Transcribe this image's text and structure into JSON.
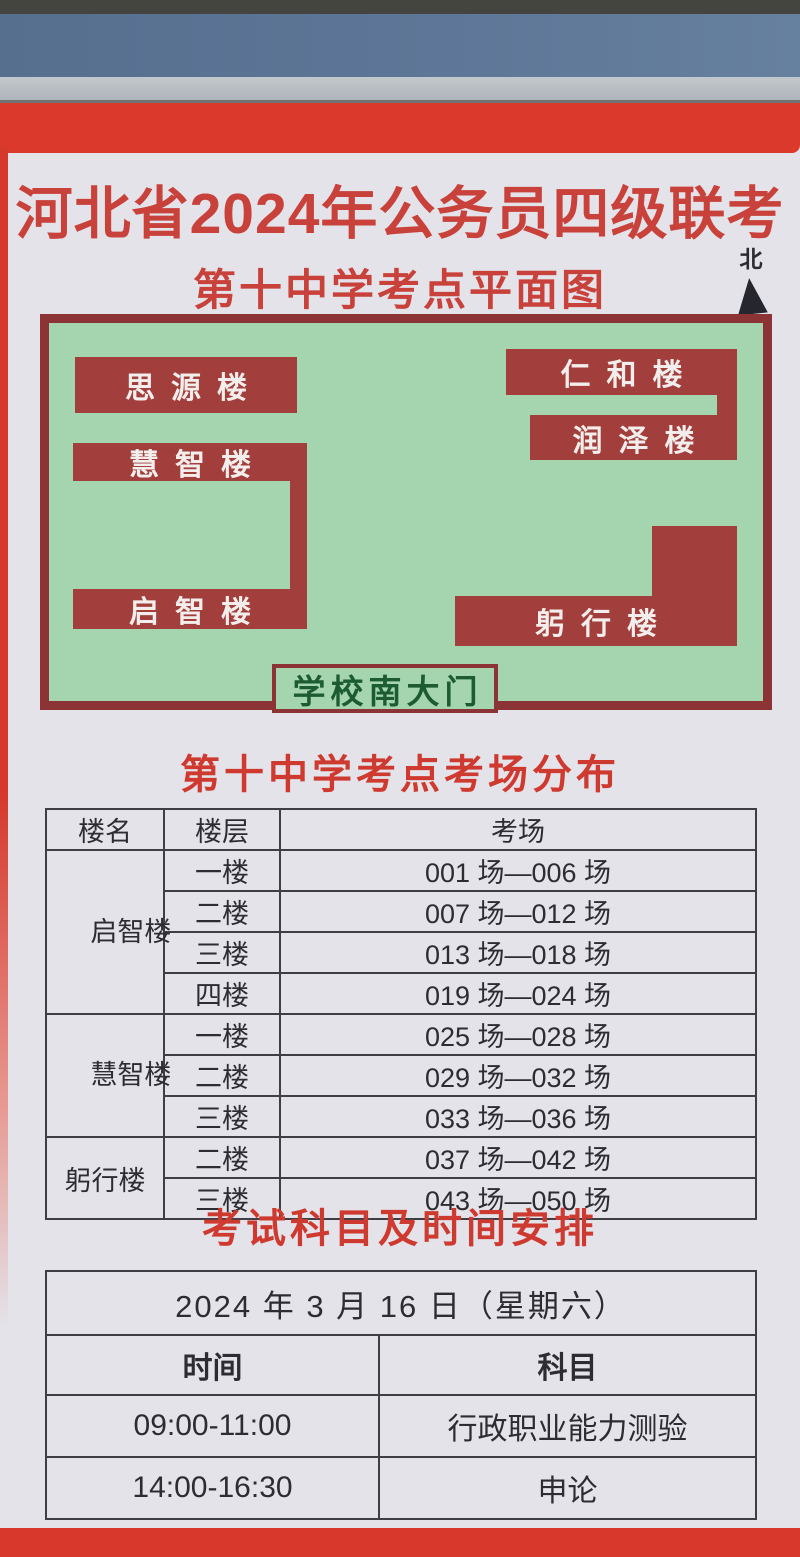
{
  "poster": {
    "title": "河北省2024年公务员四级联考",
    "subtitle": "第十中学考点平面图",
    "north_label": "北",
    "map": {
      "buildings": [
        {
          "id": "siyuan",
          "label": "思源楼"
        },
        {
          "id": "renhe",
          "label": "仁和楼"
        },
        {
          "id": "runze",
          "label": "润泽楼"
        },
        {
          "id": "huizhi",
          "label": "慧智楼"
        },
        {
          "id": "qizhi",
          "label": "启智楼"
        },
        {
          "id": "gongxing",
          "label": "躬行楼"
        }
      ],
      "gate_label": "学校南大门"
    },
    "room_table": {
      "title": "第十中学考点考场分布",
      "headers": [
        "楼名",
        "楼层",
        "考场"
      ],
      "groups": [
        {
          "building": "启智楼",
          "rows": [
            {
              "floor": "一楼",
              "rooms": "001 场—006 场"
            },
            {
              "floor": "二楼",
              "rooms": "007 场—012 场"
            },
            {
              "floor": "三楼",
              "rooms": "013 场—018 场"
            },
            {
              "floor": "四楼",
              "rooms": "019 场—024 场"
            }
          ]
        },
        {
          "building": "慧智楼",
          "rows": [
            {
              "floor": "一楼",
              "rooms": "025 场—028 场"
            },
            {
              "floor": "二楼",
              "rooms": "029 场—032 场"
            },
            {
              "floor": "三楼",
              "rooms": "033 场—036 场"
            }
          ]
        },
        {
          "building": "躬行楼",
          "rows": [
            {
              "floor": "二楼",
              "rooms": "037 场—042 场"
            },
            {
              "floor": "三楼",
              "rooms": "043 场—050 场"
            }
          ]
        }
      ]
    },
    "schedule": {
      "title": "考试科目及时间安排",
      "date_header": "2024 年 3 月 16 日（星期六）",
      "columns": [
        "时间",
        "科目"
      ],
      "rows": [
        {
          "time": "09:00-11:00",
          "subject": "行政职业能力测验"
        },
        {
          "time": "14:00-16:30",
          "subject": "申论"
        }
      ]
    },
    "colors": {
      "frame_red": "#d93a2c",
      "title_red": "#c8413a",
      "map_green": "#a5d5ae",
      "map_border_maroon": "#8c3435",
      "building_red": "#a23f3d",
      "gate_text_green": "#1d5c33"
    }
  }
}
